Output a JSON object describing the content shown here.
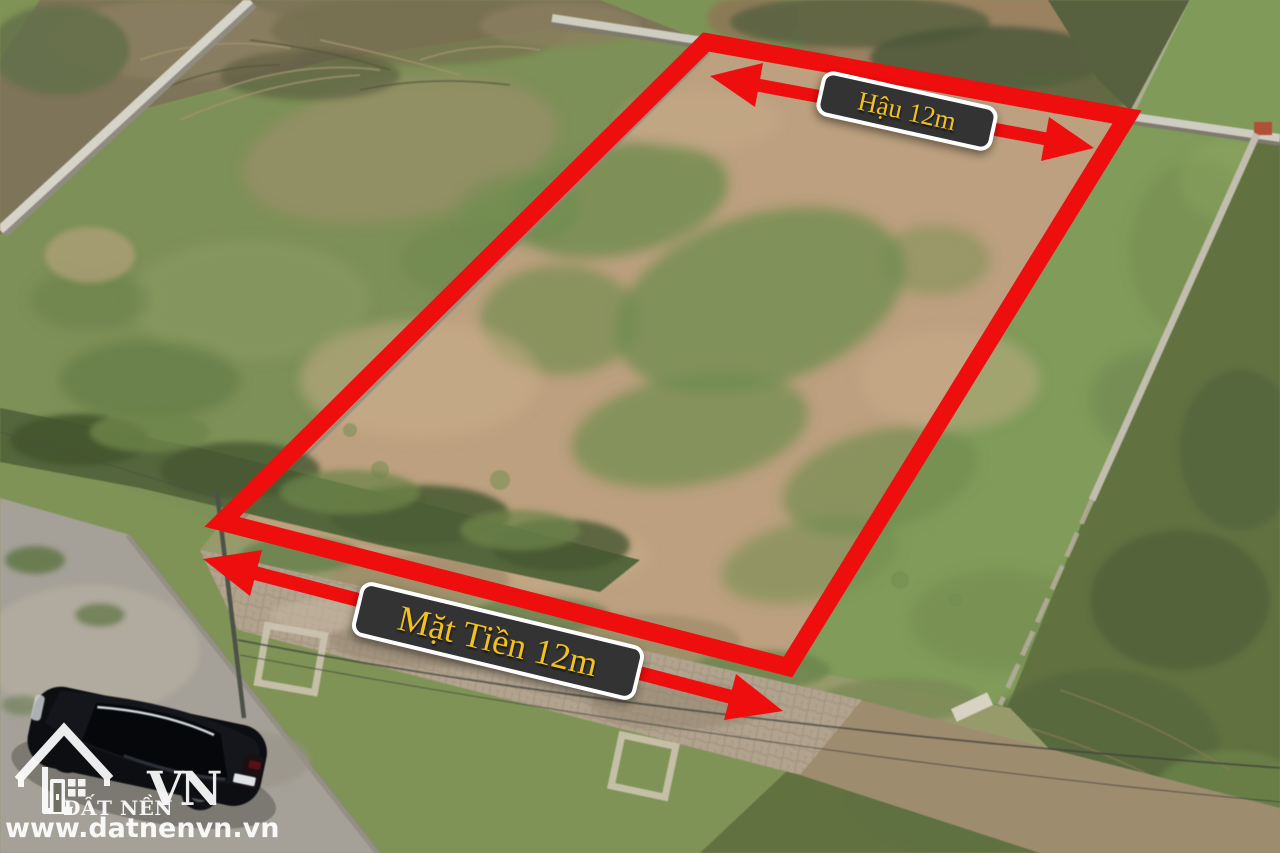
{
  "annotations": {
    "rear": {
      "label": "Hậu 12m"
    },
    "front": {
      "label": "Mặt Tiền 12m"
    },
    "outline_color": "#ee0e0e",
    "label_bg": "#333333",
    "label_border": "#ffffff",
    "label_text_color": "#f2c11d"
  },
  "watermark": {
    "brand": "ĐẤT NỀN",
    "brand_suffix": "VN",
    "website": "www.datnenvn.vn",
    "icon": "house-outline-icon",
    "color": "#ffffff"
  },
  "scene": {
    "colors": {
      "plot_dirt": "#bda07e",
      "grass": "#7f9a57",
      "dark_scrub": "#61713f",
      "dry_brush": "#7e7458",
      "road": "#a5a198",
      "wall": "#d6d3c8",
      "pavers": "#b2a38e",
      "car_body": "#0c0e12"
    }
  }
}
